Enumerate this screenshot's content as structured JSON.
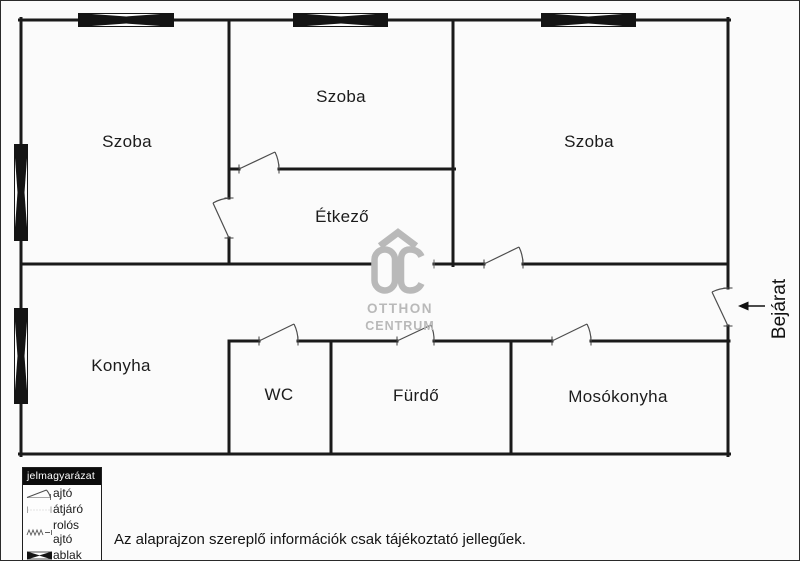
{
  "colors": {
    "wall": "#1a1a1a",
    "door_line": "#4d4d4d",
    "logo_gray": "#b9b9b9"
  },
  "rooms": {
    "szoba_left": "Szoba",
    "szoba_middle": "Szoba",
    "szoba_right": "Szoba",
    "etkezo": "Étkező",
    "konyha": "Konyha",
    "wc": "WC",
    "furdo": "Fürdő",
    "mosokonyha": "Mosókonyha"
  },
  "entrance": {
    "label": "Bejárat"
  },
  "watermark": {
    "monogram": "OC",
    "line1": "OTTHON",
    "line2": "CENTRUM"
  },
  "legend": {
    "title": "jelmagyarázat",
    "items": [
      {
        "symbol": "door-swing-icon",
        "label": "ajtó"
      },
      {
        "symbol": "passage-icon",
        "label": "átjáró"
      },
      {
        "symbol": "roller-door-icon",
        "label": "rolós ajtó"
      },
      {
        "symbol": "window-icon",
        "label": "ablak"
      }
    ]
  },
  "disclaimer": "Az alaprajzon szereplő információk csak tájékoztató jellegűek."
}
